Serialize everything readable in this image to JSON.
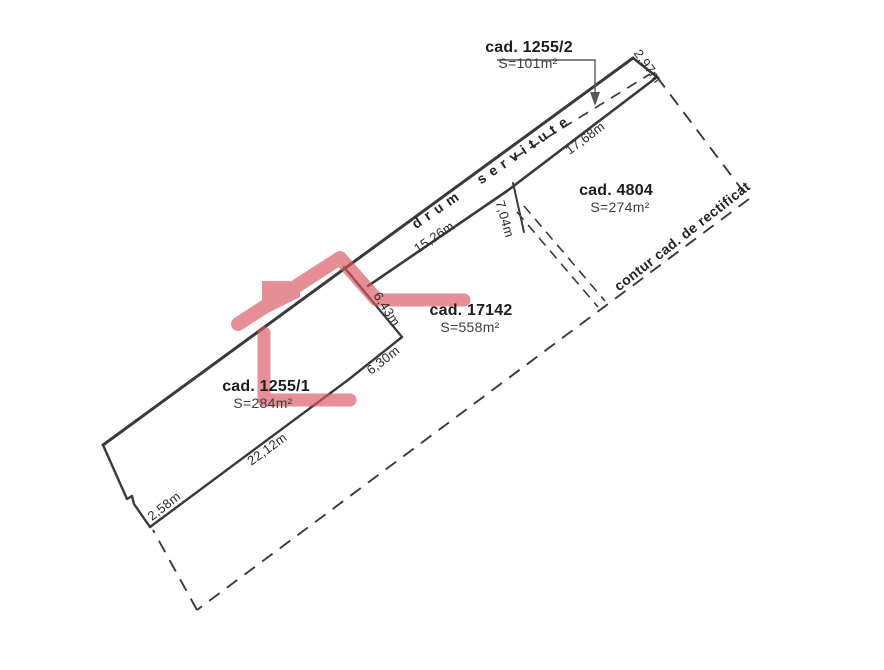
{
  "plan": {
    "parcels": {
      "road_1255_2": {
        "name": "cad. 1255/2",
        "area": "S=101m²"
      },
      "p4804": {
        "name": "cad. 4804",
        "area": "S=274m²"
      },
      "p17142": {
        "name": "cad. 17142",
        "area": "S=558m²"
      },
      "p1255_1": {
        "name": "cad. 1255/1",
        "area": "S=284m²"
      }
    },
    "road_text": "drum servitute",
    "contour_text": "contur cad. de rectificat",
    "dimensions": {
      "cap_ne": "2,97m",
      "road_ne": "17,68m",
      "road_sw": "15,26m",
      "split": "7,04m",
      "east_upper": "6,43m",
      "east_lower": "6,30m",
      "south": "22,12m",
      "cap_w": "2,58m"
    },
    "colors": {
      "line": "#3a3a3a",
      "overlay_red": "#d9555c",
      "leader": "#595959"
    }
  }
}
